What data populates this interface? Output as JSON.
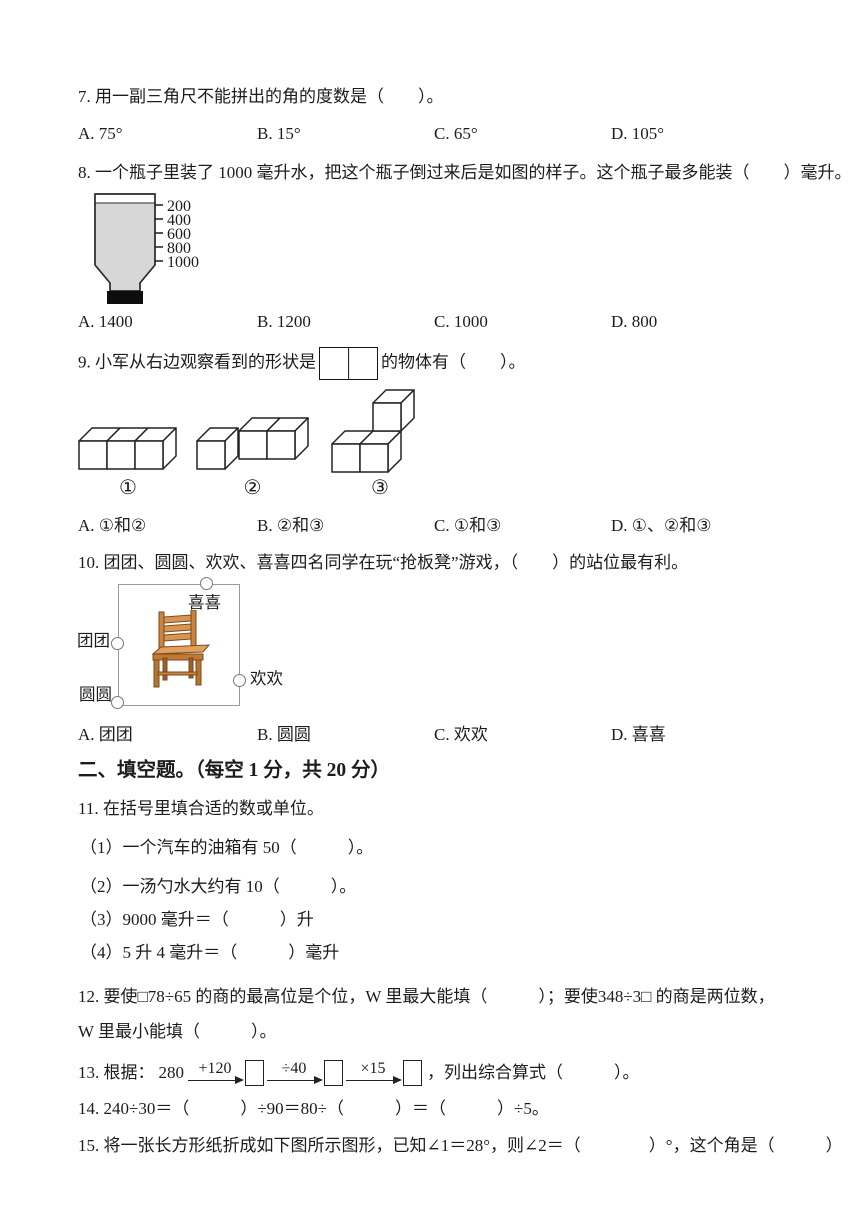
{
  "q7": {
    "text": "7. 用一副三角尺不能拼出的角的度数是（　　）。",
    "options": [
      "A. 75°",
      "B. 15°",
      "C. 65°",
      "D. 105°"
    ]
  },
  "q8": {
    "text": "8. 一个瓶子里装了 1000 毫升水，把这个瓶子倒过来后是如图的样子。这个瓶子最多能装（　　）毫升。",
    "scale": [
      "200",
      "400",
      "600",
      "800",
      "1000"
    ],
    "options": [
      "A. 1400",
      "B. 1200",
      "C. 1000",
      "D. 800"
    ]
  },
  "q9": {
    "before": "9. 小军从右边观察看到的形状是",
    "after": "的物体有（　　）。",
    "fig_labels": [
      "①",
      "②",
      "③"
    ],
    "options": [
      "A. ①和②",
      "B. ②和③",
      "C. ①和③",
      "D. ①、②和③"
    ]
  },
  "q10": {
    "text": "10. 团团、圆圆、欢欢、喜喜四名同学在玩“抢板凳”游戏，（　　）的站位最有利。",
    "players": {
      "top": "喜喜",
      "left": "团团",
      "bottom_left": "圆圆",
      "right": "欢欢"
    },
    "options": [
      "A. 团团",
      "B. 圆圆",
      "C. 欢欢",
      "D. 喜喜"
    ]
  },
  "section2": {
    "title": "二、填空题。（每空 1 分，共 20 分）"
  },
  "q11": {
    "text": "11. 在括号里填合适的数或单位。",
    "subs": [
      "（1）一个汽车的油箱有 50（　　　）。",
      "（2）一汤勺水大约有 10（　　　）。",
      "（3）9000 毫升＝（　　　）升",
      "（4）5 升 4 毫升＝（　　　）毫升"
    ]
  },
  "q12": {
    "text": "12. 要使□78÷65 的商的最高位是个位，W 里最大能填（　　　）；要使348÷3□ 的商是两位数，W 里最小能填（　　　）。"
  },
  "q13": {
    "lead": "13. 根据：",
    "start": "280",
    "steps": [
      "+120",
      "÷40",
      "×15"
    ],
    "suffix": "，列出综合算式（　　　）。"
  },
  "q14": {
    "text": "14. 240÷30＝（　　　）÷90＝80÷（　　　）＝（　　　）÷5。"
  },
  "q15": {
    "text": "15. 将一张长方形纸折成如下图所示图形，已知∠1＝28°，则∠2＝（　　　　）°，这个角是（　　　）"
  }
}
